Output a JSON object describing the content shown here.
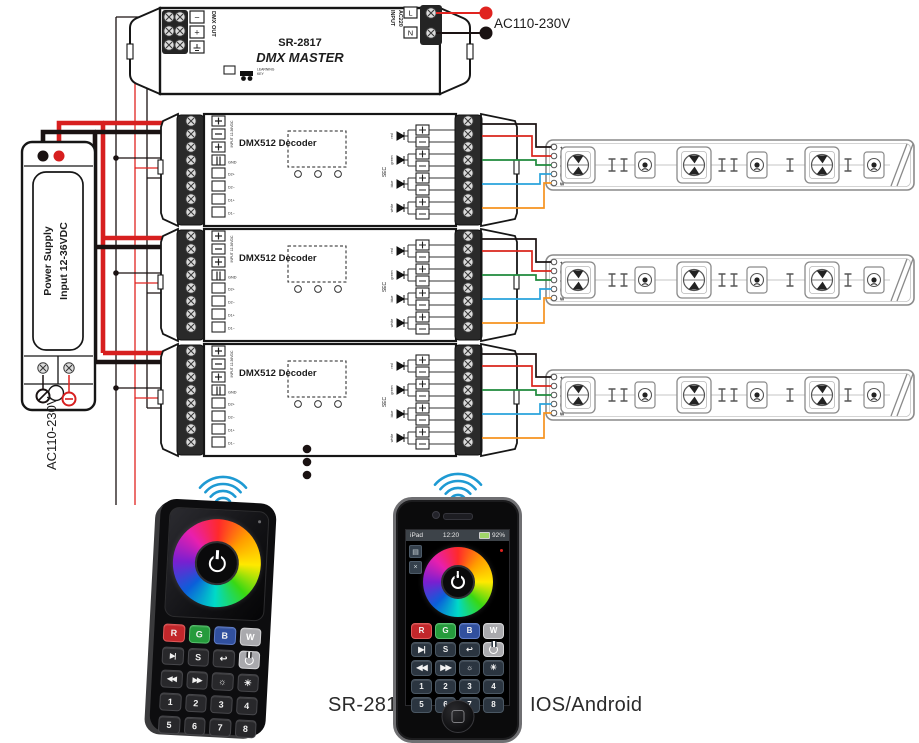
{
  "diagram": {
    "ac_input_label": "AC110-230V",
    "master": {
      "model": "SR-2817",
      "name": "DMX MASTER",
      "dmx_out": "DMX OUT",
      "out_minus": "−",
      "out_plus": "+",
      "input_line1": "INPUT",
      "input_line2": "AC220",
      "live": "L",
      "neutral": "N",
      "learn_line1": "LEARNING",
      "learn_line2": "KEY"
    },
    "power_supply": {
      "line1": "Power Supply",
      "line2": "Input 12-36VDC",
      "ac_label": "AC110-230V"
    },
    "decoder": {
      "title": "DMX512 Decoder",
      "input_plus": "+",
      "input_minus": "−",
      "aux_plus": "+",
      "gnd": "GND",
      "input_side_label": "INPUT 12-36VDC",
      "dmx_labels": [
        "D2+",
        "D2−",
        "D1+",
        "D1−"
      ],
      "channels": [
        "red",
        "green",
        "blue",
        "white"
      ],
      "sec": "SEC"
    },
    "strip": {
      "pins": [
        "+",
        "R",
        "G",
        "B",
        "W"
      ]
    },
    "wire_colors": {
      "power_red": "#d71f1f",
      "power_black": "#1a1212",
      "ch_red": "#d9251c",
      "ch_green": "#1f8a3c",
      "ch_blue": "#29a3dc",
      "ch_white": "#f6921e",
      "wifi_blue": "#1e9ad3"
    }
  },
  "remote": {
    "model": "SR-2818"
  },
  "phone": {
    "label": "IOS/Android",
    "status": {
      "carrier": "iPad",
      "time": "12:20",
      "battery": "92%"
    }
  },
  "controls": {
    "rows": [
      [
        "R",
        "G",
        "B",
        "W"
      ],
      [
        "▶|",
        "S",
        "↩",
        "PWR"
      ],
      [
        "◀◀",
        "▶▶",
        "☼",
        "☀"
      ],
      [
        "1",
        "2",
        "3",
        "4"
      ],
      [
        "5",
        "6",
        "7",
        "8"
      ]
    ]
  }
}
